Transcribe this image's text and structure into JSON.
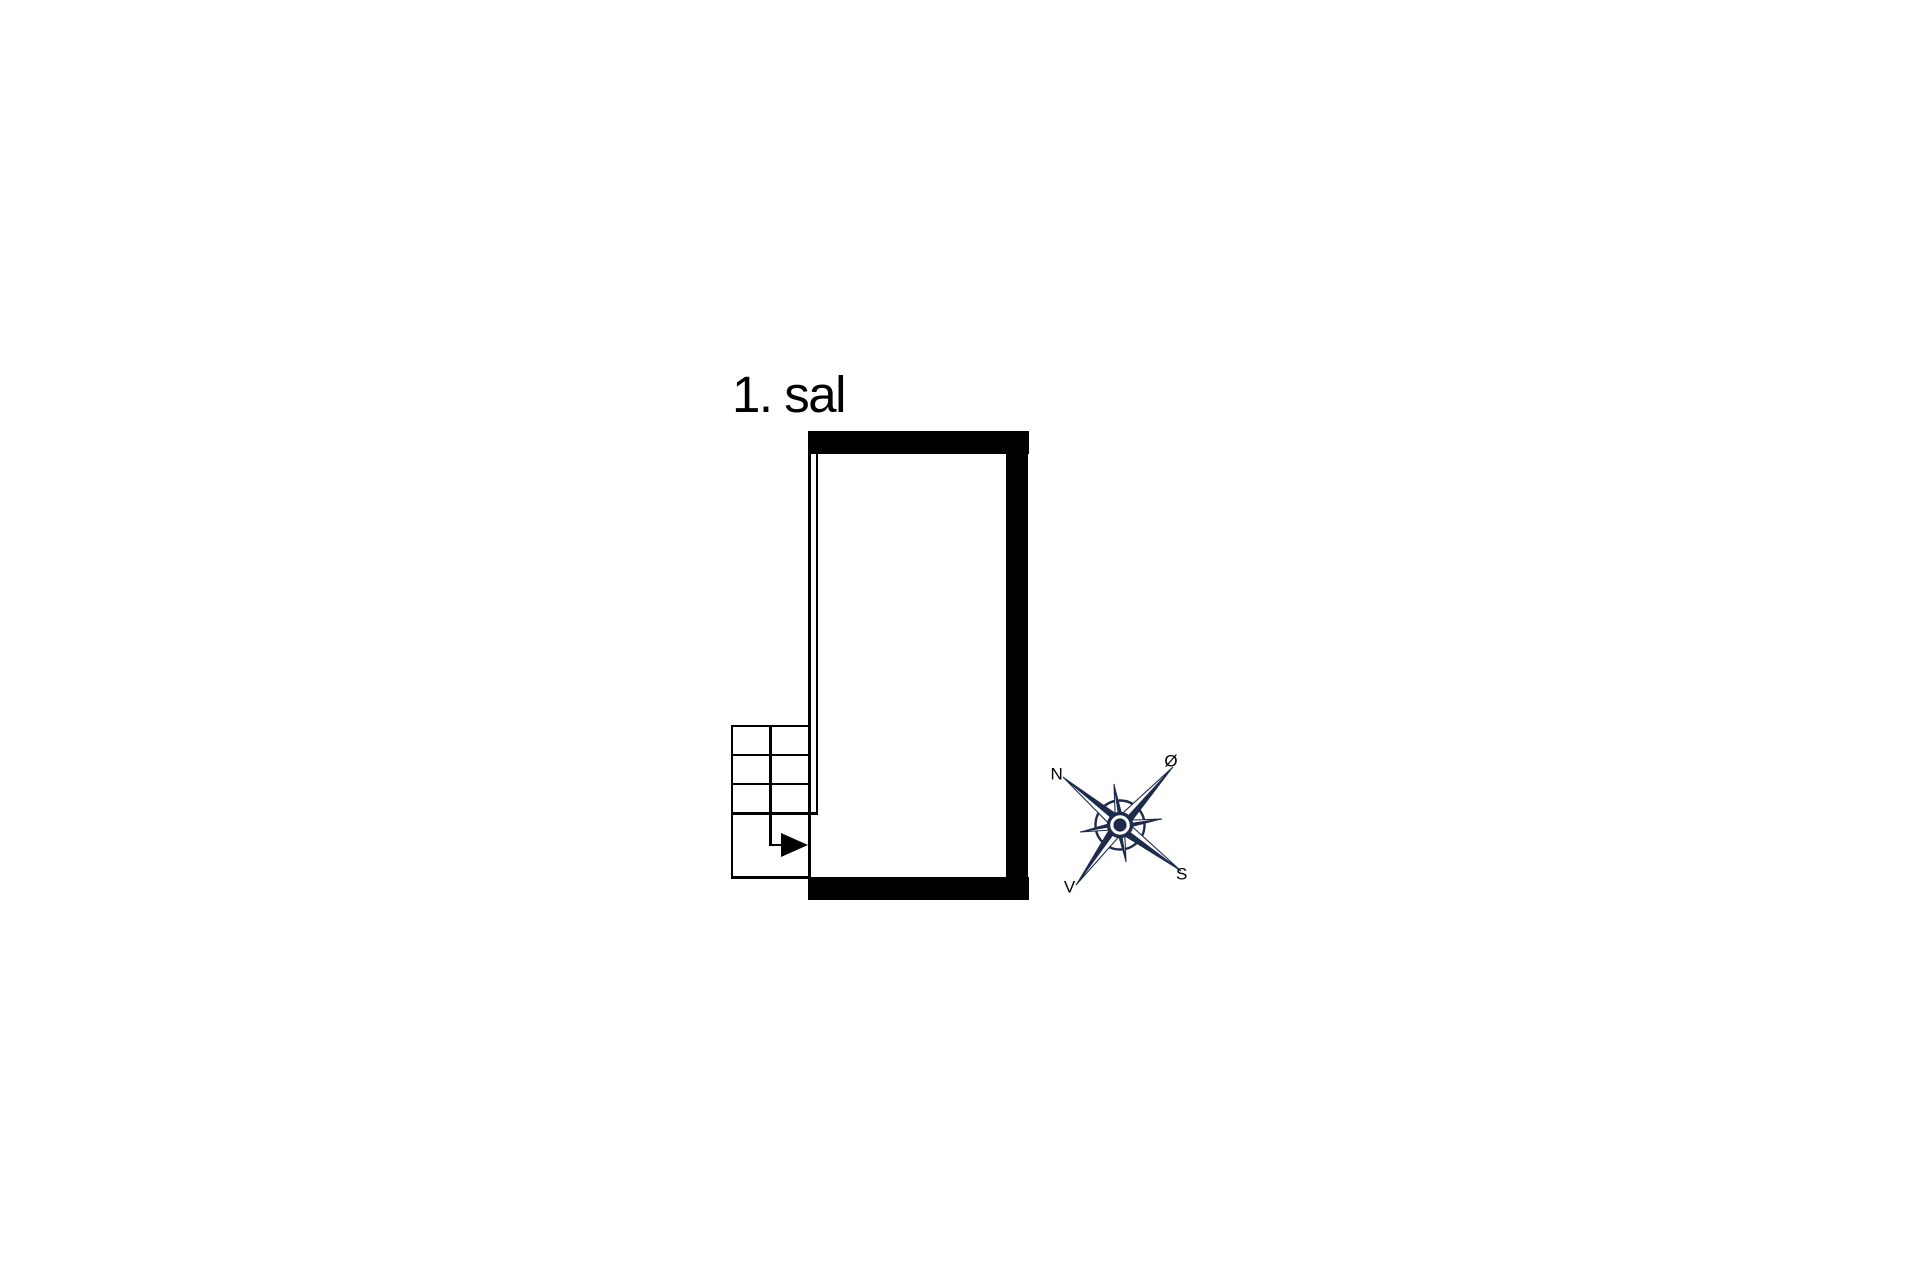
{
  "page": {
    "title": "1. sal"
  },
  "compass": {
    "labels": {
      "north": "N",
      "east": "Ø",
      "south": "S",
      "west": "V"
    }
  },
  "icons": {
    "compass-rose-icon": "eight-point-star",
    "arrow-head": "right-pointing-triangle"
  },
  "colors": {
    "background": "#ffffff",
    "ink": "#000000",
    "navy": "#1f2b4c"
  }
}
